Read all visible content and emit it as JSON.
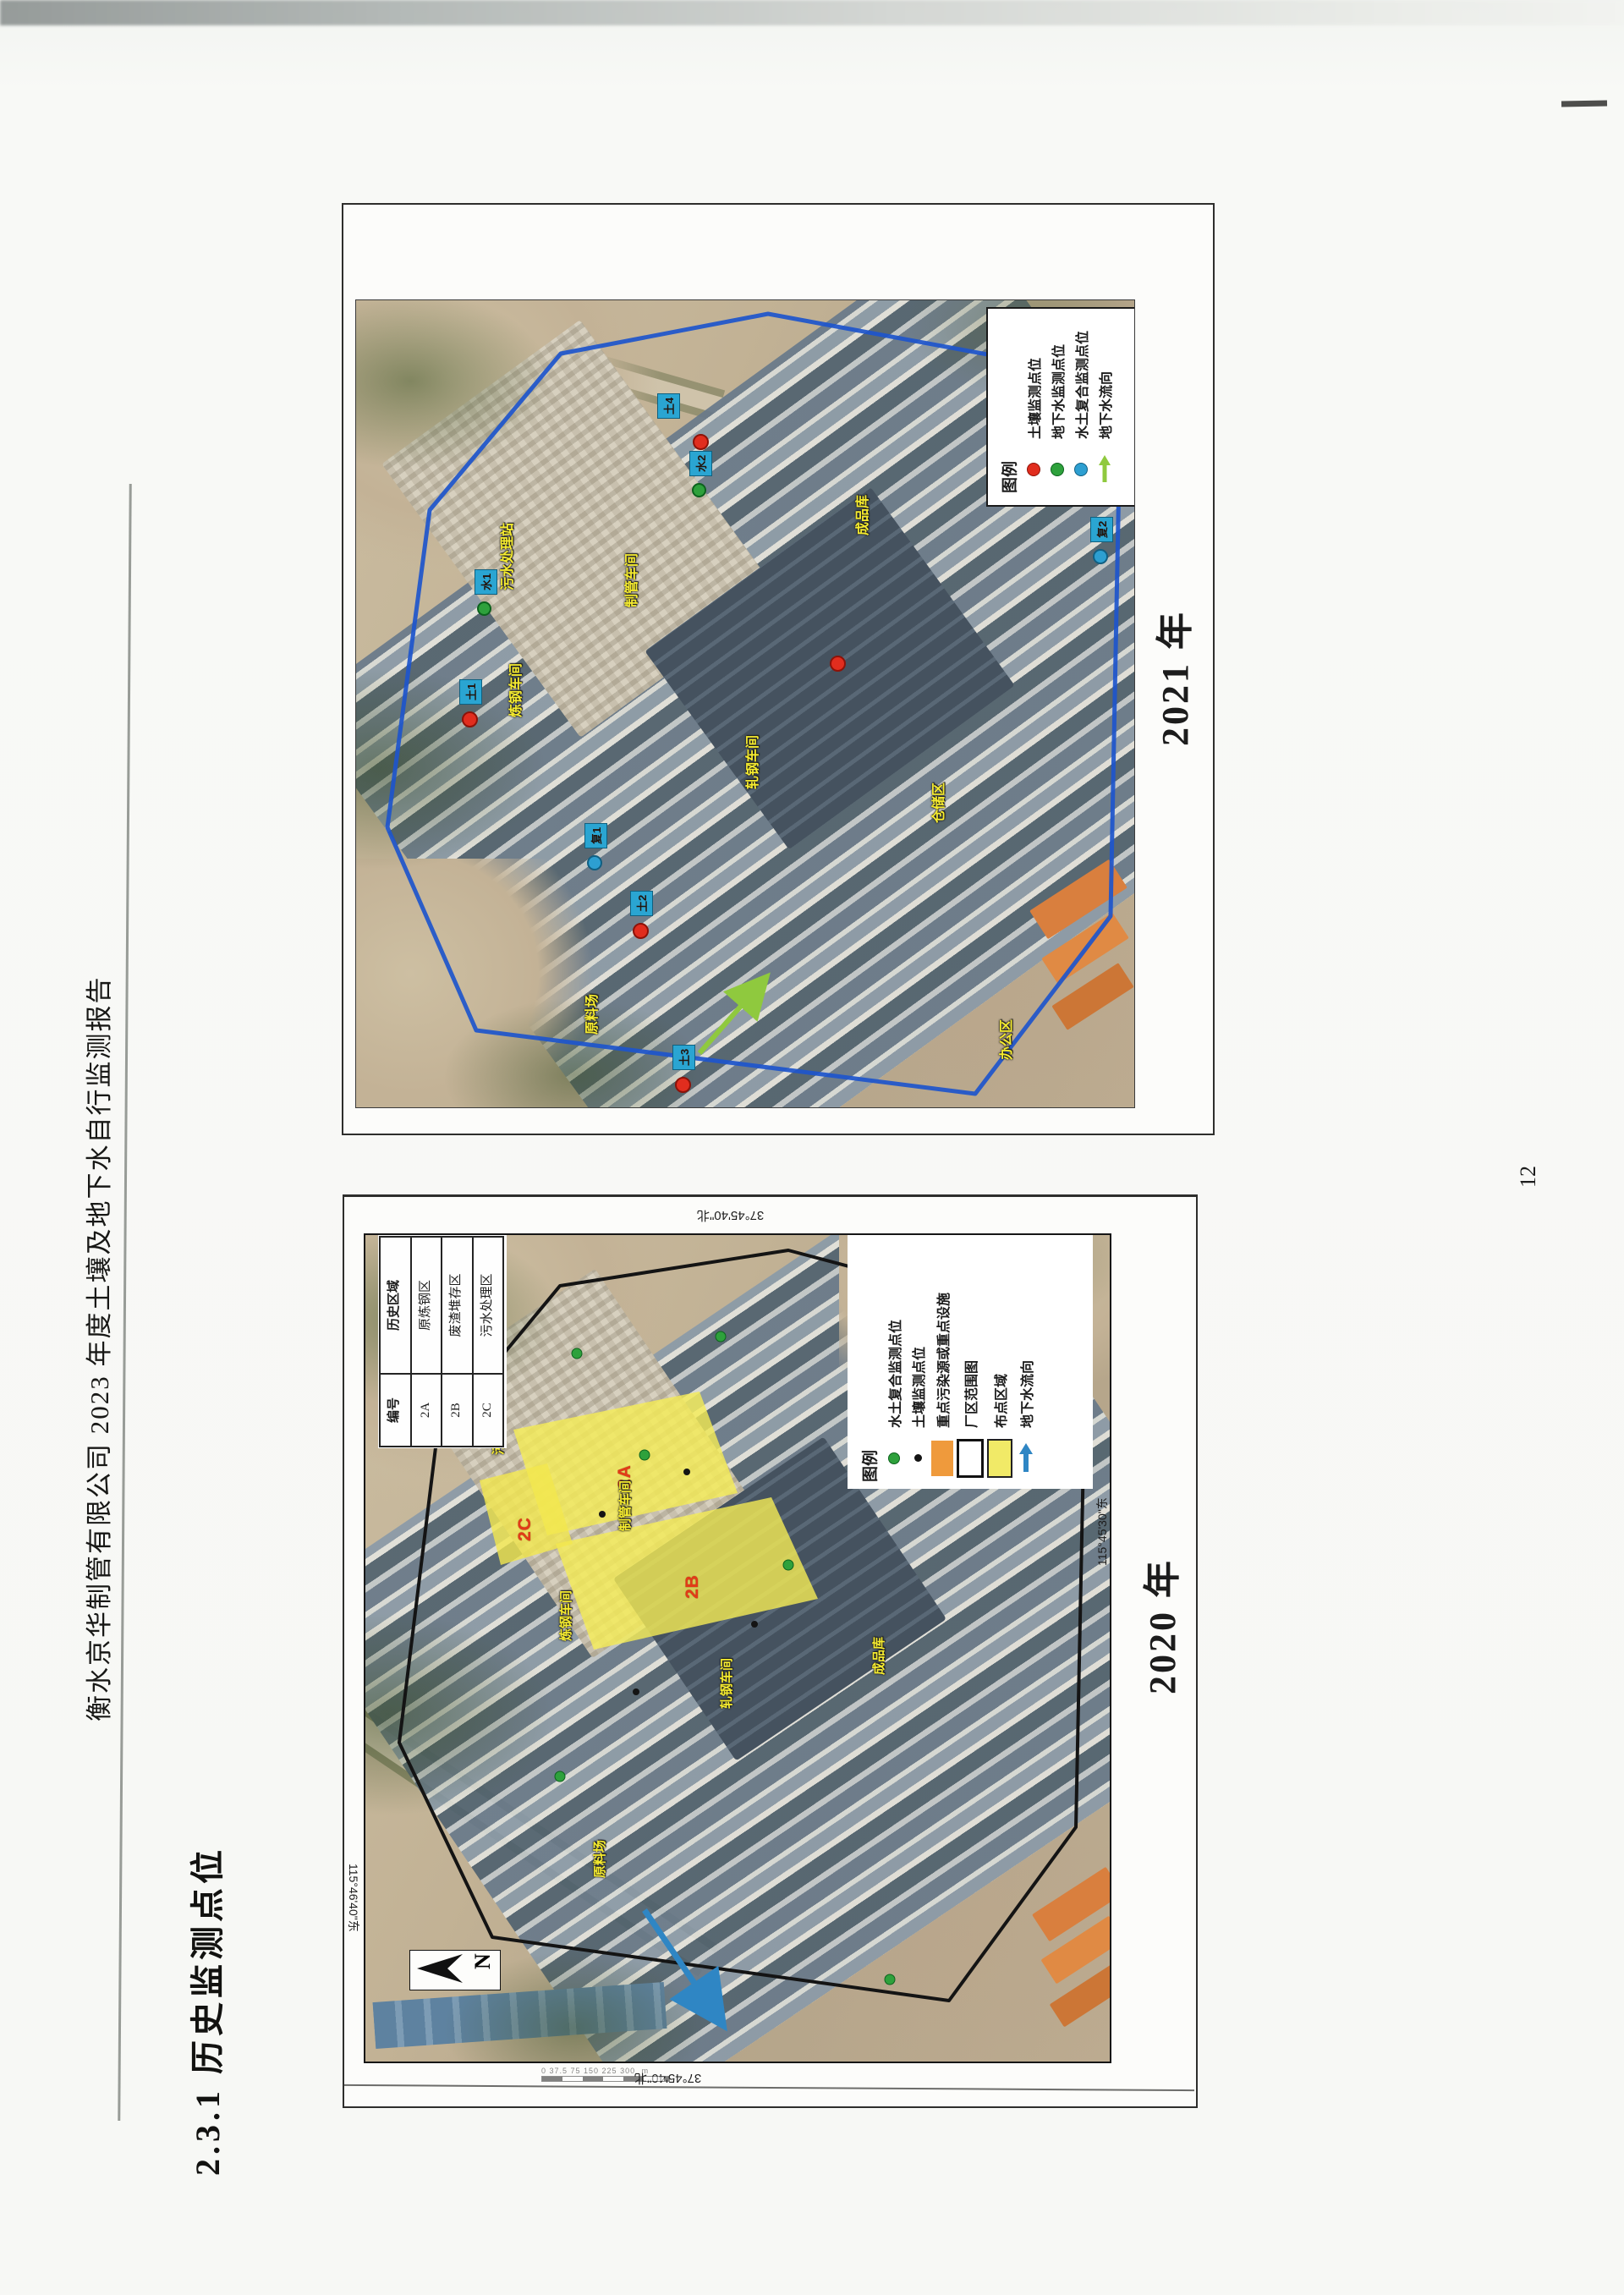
{
  "page": {
    "side_title": "衡水京华制管有限公司 2023 年度土壤及地下水自行监测报告",
    "section_heading": "2.3.1  历史监测点位",
    "page_number": "12"
  },
  "colors": {
    "boundary_2021": "#1d55cc",
    "boundary_2020": "#141414",
    "soil_point": "#e12d1e",
    "groundwater_point": "#2ea13c",
    "composite_point": "#2d9fd1",
    "flow_arrow_2021": "#8fc93e",
    "flow_arrow_2020": "#2f86c4",
    "key_source_swatch": "#ef9a3c",
    "zone_swatch": "#f1ea67",
    "point_label_box": "#2aa5d2",
    "map_text_yellow": "#f6ec2f"
  },
  "fig2021": {
    "year_label": "2021 年",
    "legend": {
      "title": "图例",
      "items": [
        {
          "marker": "red-dot",
          "label": "土壤监测点位"
        },
        {
          "marker": "green-dot",
          "label": "地下水监测点位"
        },
        {
          "marker": "blue-dot",
          "label": "水土复合监测点位"
        },
        {
          "marker": "green-arrow",
          "label": "地下水流向"
        }
      ]
    },
    "point_labels": [
      "水1",
      "土1",
      "复1",
      "土2",
      "土3",
      "水2",
      "复2",
      "土4"
    ],
    "area_labels": [
      "污水处理站",
      "制管车间",
      "炼钢车间",
      "轧钢车间",
      "成品库",
      "仓储区",
      "原料场",
      "办公区"
    ]
  },
  "fig2020": {
    "year_label": "2020 年",
    "legend": {
      "title": "图例",
      "items": [
        {
          "marker": "green-dot",
          "label": "水土复合监测点位"
        },
        {
          "marker": "black-dot",
          "label": "土壤监测点位"
        },
        {
          "marker": "orange-rect",
          "label": "重点污染源或重点设施"
        },
        {
          "marker": "white-rect",
          "label": "厂区范围图"
        },
        {
          "marker": "yellow-rect",
          "label": "布点区域"
        },
        {
          "marker": "blue-arrow",
          "label": "地下水流向"
        }
      ]
    },
    "table": {
      "headers": [
        "编号",
        "历史区域"
      ],
      "rows": [
        {
          "id": "2A",
          "area": "原炼钢区"
        },
        {
          "id": "2B",
          "area": "废渣堆存区"
        },
        {
          "id": "2C",
          "area": "污水处理区"
        }
      ]
    },
    "coord_labels": {
      "top": "37°45'40\"北",
      "bottom": "37°45'40\"北",
      "left": "115°46'40\"东",
      "right": "115°45'30\"东"
    },
    "zone_labels": [
      "2A",
      "2B",
      "2C"
    ],
    "north_label": "N",
    "scale_ticks": "0  37.5  75   150   225   300",
    "scale_unit": "m",
    "area_labels": [
      "污水处理站",
      "制管车间",
      "炼钢车间",
      "轧钢车间",
      "原料场",
      "成品库"
    ]
  }
}
